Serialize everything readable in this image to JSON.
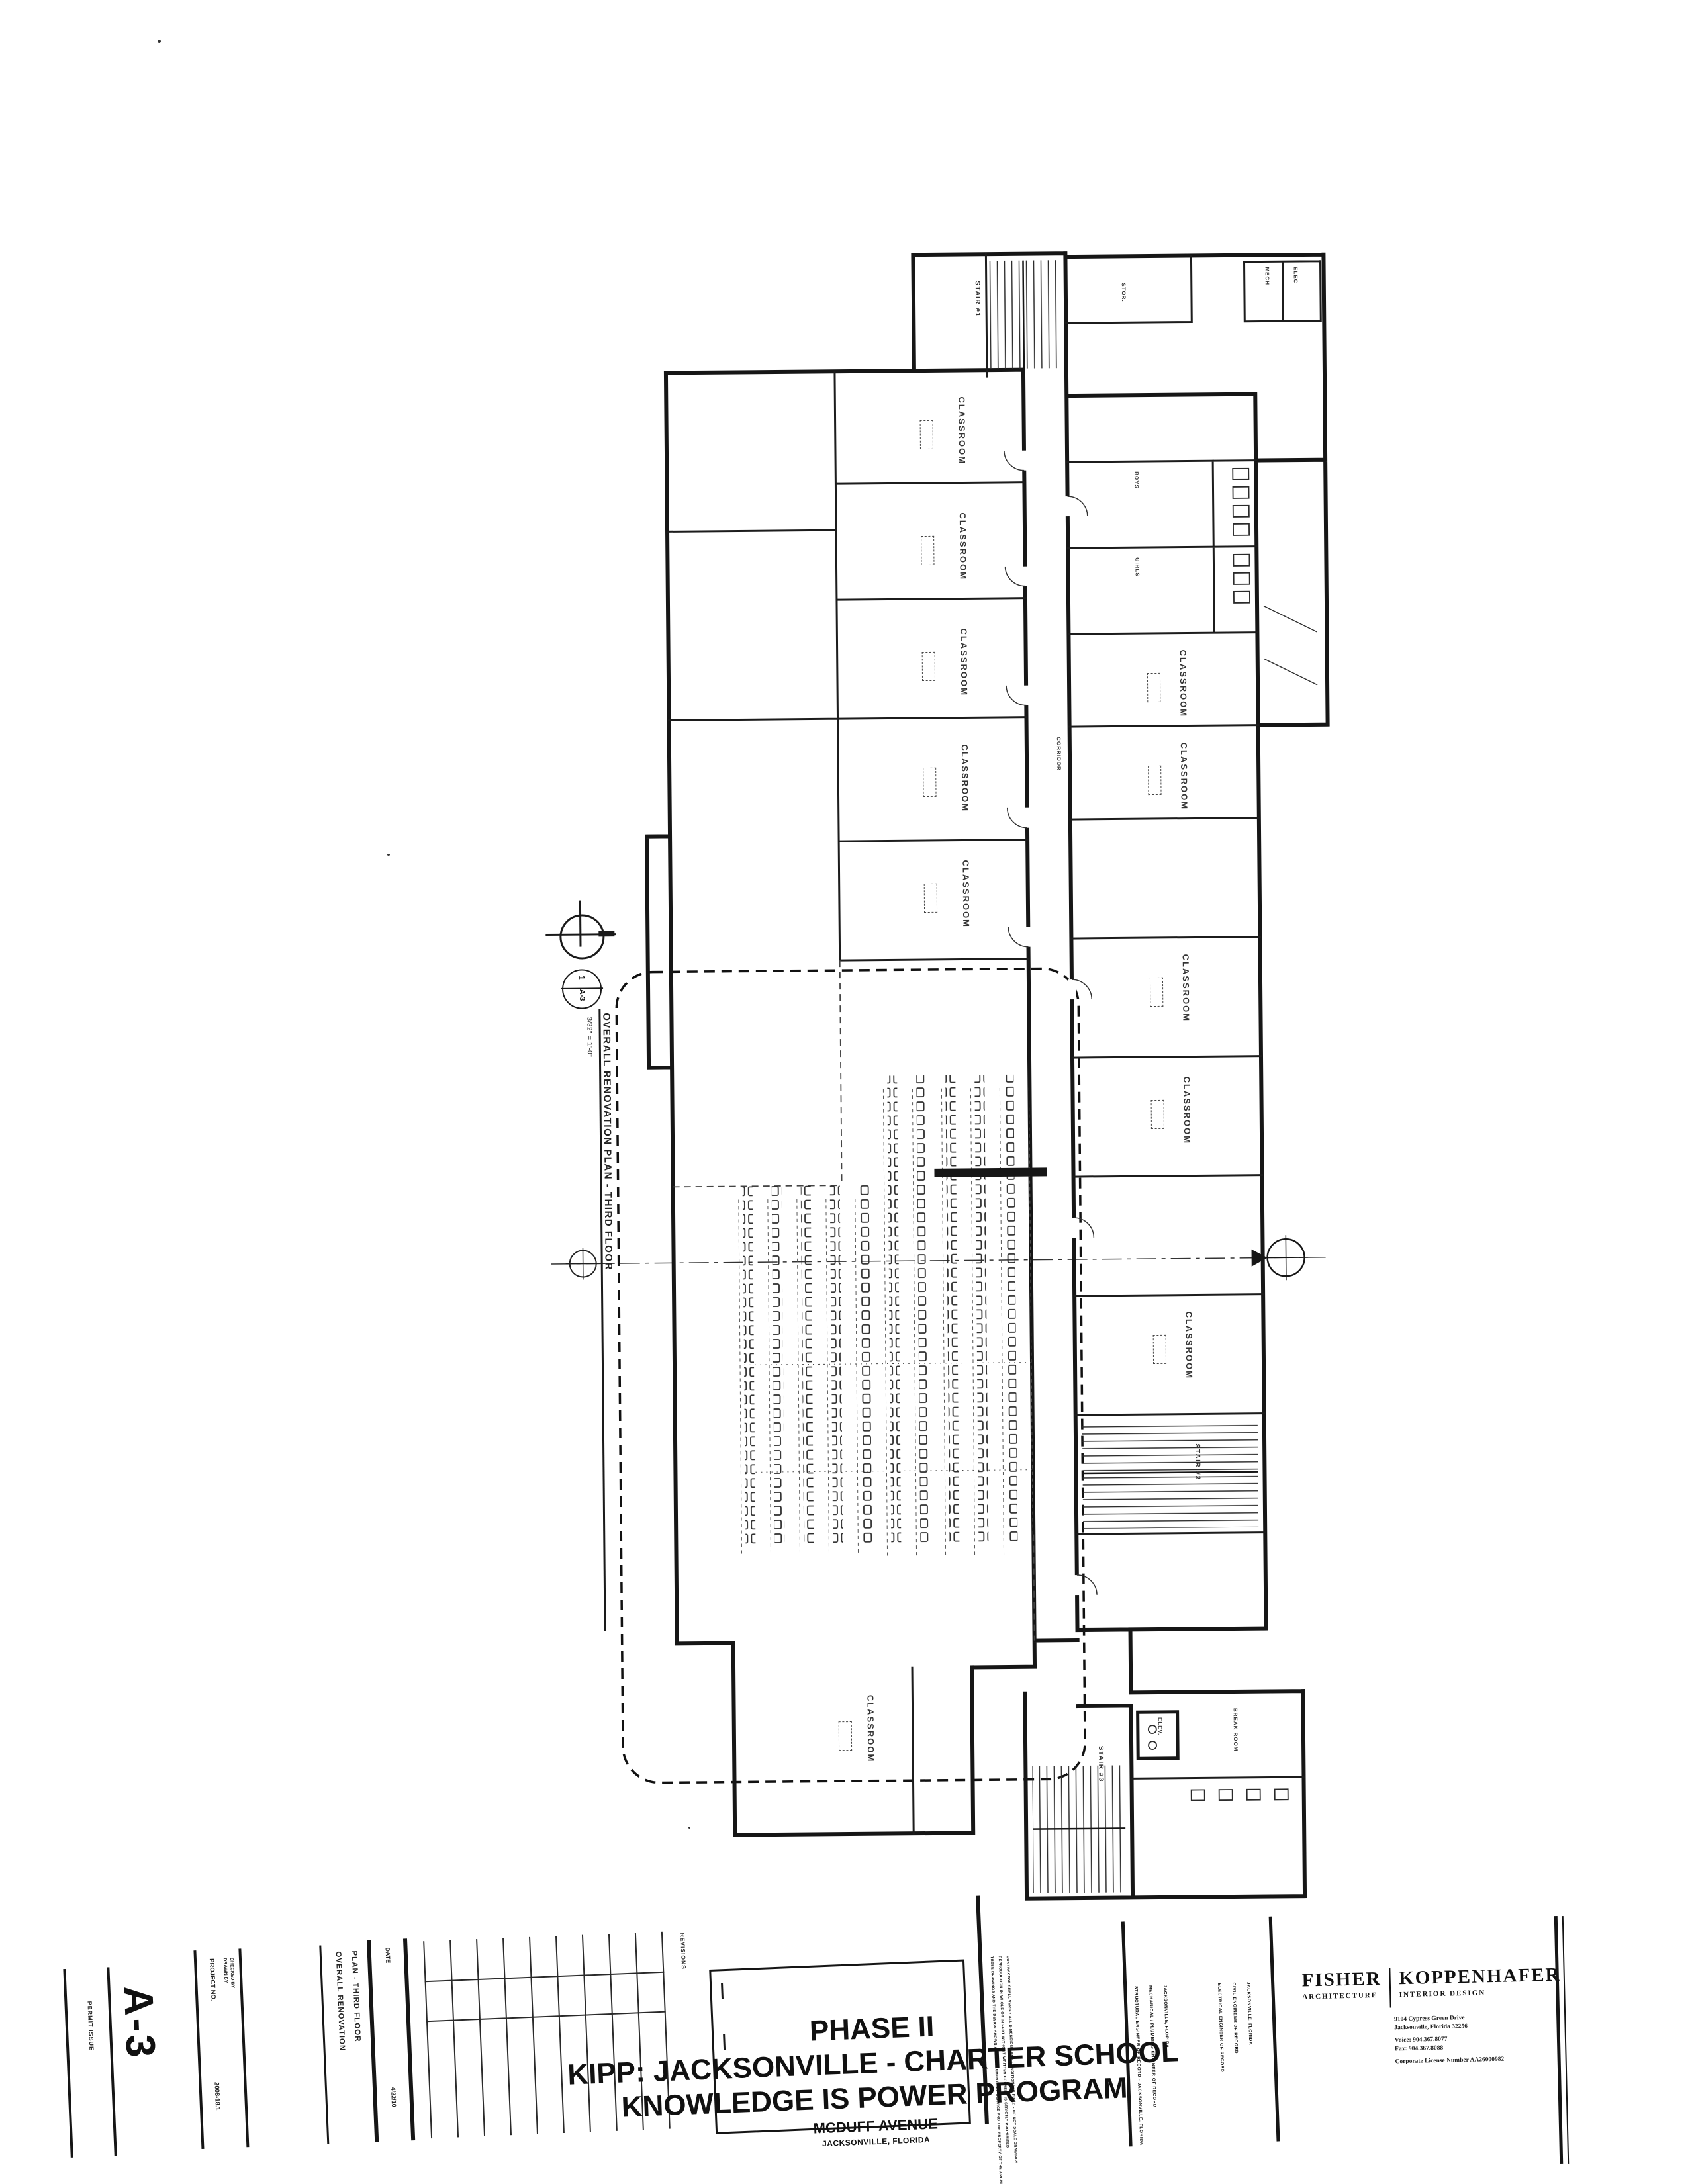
{
  "plan": {
    "callout": {
      "detail_number": "1",
      "detail_sheet": "A-3",
      "title": "OVERALL RENOVATION PLAN  -  THIRD FLOOR",
      "scale": "3/32\" = 1'-0\""
    },
    "rooms": [
      {
        "label": "CLASSROOM"
      },
      {
        "label": "CLASSROOM"
      },
      {
        "label": "CLASSROOM"
      },
      {
        "label": "CLASSROOM"
      },
      {
        "label": "CLASSROOM"
      },
      {
        "label": "CLASSROOM"
      },
      {
        "label": "CLASSROOM"
      },
      {
        "label": "CLASSROOM"
      },
      {
        "label": "CLASSROOM"
      },
      {
        "label": "CLASSROOM"
      },
      {
        "label": "STAIR #1"
      },
      {
        "label": "STAIR #2"
      },
      {
        "label": "STAIR #3"
      },
      {
        "label": "BOYS"
      },
      {
        "label": "GIRLS"
      },
      {
        "label": "MECH"
      },
      {
        "label": "ELEC"
      },
      {
        "label": "STOR."
      },
      {
        "label": "CORRIDOR"
      },
      {
        "label": "BREAK ROOM"
      },
      {
        "label": "ELEV."
      },
      {
        "label": "CLASSROOM"
      }
    ]
  },
  "titleblock": {
    "permit_issue": "PERMIT ISSUE",
    "sheet_number": "A-3",
    "project_no_label": "PROJECT NO.",
    "project_no": "2008-18.1",
    "drawn_by_label": "DRAWN BY",
    "checked_by_label": "CHECKED BY",
    "sheet_title_line1": "OVERALL RENOVATION",
    "sheet_title_line2": "PLAN  -  THIRD FLOOR",
    "date_label": "DATE",
    "date": "4/22/10",
    "revisions_label": "REVISIONS"
  },
  "project": {
    "phase": "PHASE II",
    "name": "KIPP: JACKSONVILLE - CHARTER SCHOOL",
    "program": "KNOWLEDGE IS POWER PROGRAM",
    "address": "MCDUFF AVENUE",
    "city": "JACKSONVILLE, FLORIDA"
  },
  "firm": {
    "name_left": "FISHER",
    "name_right": "KOPPENHAFER",
    "discipline_left": "ARCHITECTURE",
    "discipline_right": "INTERIOR DESIGN",
    "address_line1": "9104 Cypress Green Drive",
    "address_line2": "Jacksonville, Florida 32256",
    "voice": "Voice:  904.367.8077",
    "fax": "Fax:     904.367.8088",
    "license": "Corporate License Number AA26000982"
  },
  "consultants": [
    "STRUCTURAL ENGINEER OF RECORD - JACKSONVILLE, FLORIDA",
    "MECHANICAL / PLUMBING ENGINEER OF RECORD",
    "JACKSONVILLE, FLORIDA",
    "ELECTRICAL ENGINEER OF RECORD",
    "CIVIL ENGINEER OF RECORD",
    "JACKSONVILLE, FLORIDA"
  ],
  "legal": [
    "THESE DRAWINGS AND THE DESIGN SHOWN ARE INSTRUMENTS OF SERVICE AND THE PROPERTY OF THE ARCHITECT",
    "REPRODUCTION IN WHOLE OR IN PART WITHOUT WRITTEN CONSENT IS STRICTLY PROHIBITED",
    "CONTRACTOR SHALL VERIFY ALL DIMENSIONS AND CONDITIONS IN FIELD - DO NOT SCALE DRAWINGS"
  ]
}
